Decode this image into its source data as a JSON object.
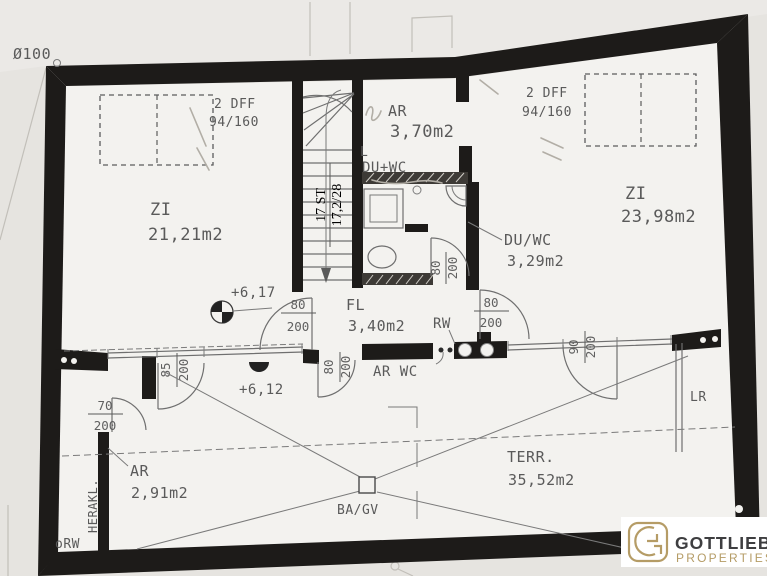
{
  "meta": {
    "wall_color": "#1d1b19",
    "paper_outer": "#e6e4e0",
    "paper_inner": "#f3f2ef",
    "gold": "#b59c66",
    "charcoal": "#3e3e40"
  },
  "notes": {
    "diameter": "Ø100",
    "orw": "oRW",
    "herakl": "HERAKL.",
    "lr": "LR",
    "ba_gv": "BA/GV",
    "rw": "RW",
    "ar_wc": "AR WC",
    "l_mark": "L"
  },
  "levels": {
    "upper": "+6,17",
    "lower": "+6,12"
  },
  "stairs": {
    "line1": "17 ST",
    "line2": "17,2/28"
  },
  "windows": {
    "left": {
      "label": "2 DFF",
      "size": "94/160"
    },
    "right": {
      "label": "2 DFF",
      "size": "94/160"
    }
  },
  "rooms": {
    "zi_left": {
      "name": "ZI",
      "area": "21,21m2"
    },
    "zi_right": {
      "name": "ZI",
      "area": "23,98m2"
    },
    "ar_top": {
      "name": "AR",
      "area": "3,70m2"
    },
    "du_wc_small": {
      "name": "DU+WC"
    },
    "du_wc": {
      "name": "DU/WC",
      "area": "3,29m2"
    },
    "fl": {
      "name": "FL",
      "area": "3,40m2"
    },
    "ar_bottom": {
      "name": "AR",
      "area": "2,91m2"
    },
    "terrace": {
      "name": "TERR.",
      "area": "35,52m2"
    }
  },
  "doors": {
    "d70": {
      "w": "70",
      "h": "200"
    },
    "d85": {
      "w": "85",
      "h": "200"
    },
    "d90": {
      "w": "90",
      "h": "200"
    },
    "d80_fl_left": {
      "w": "80",
      "h": "200"
    },
    "d80_fl_right": {
      "w": "80",
      "h": "200"
    },
    "d80_bath": {
      "w": "80",
      "h": "200"
    },
    "d80_terrace": {
      "w": "80",
      "h": "200"
    }
  },
  "logo": {
    "name": "GOTTLIEB",
    "tagline": "PROPERTIES"
  }
}
